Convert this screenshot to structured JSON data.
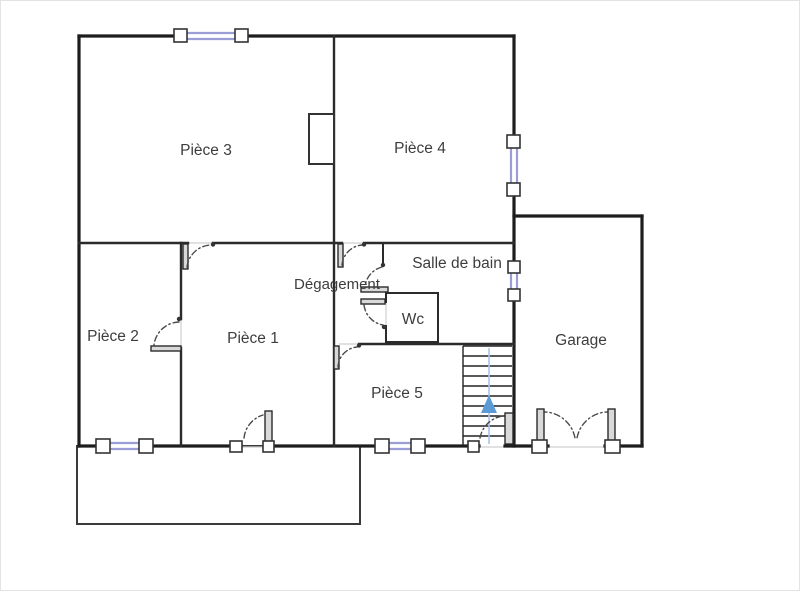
{
  "colors": {
    "wall": "#1d1d1f",
    "window_glass": "#9b9ed6",
    "stair_arrow": "#5b9bd5",
    "stair_stem": "#aac5e8",
    "label_text": "#3d3d3d"
  },
  "floor_plan": {
    "rooms": [
      {
        "label": "Pièce 3"
      },
      {
        "label": "Pièce 4"
      },
      {
        "label": "Pièce 2"
      },
      {
        "label": "Pièce 1"
      },
      {
        "label": "Pièce 5"
      },
      {
        "label": "Dégagement"
      },
      {
        "label": "Salle de bain"
      },
      {
        "label": "Wc"
      },
      {
        "label": "Garage"
      }
    ]
  }
}
